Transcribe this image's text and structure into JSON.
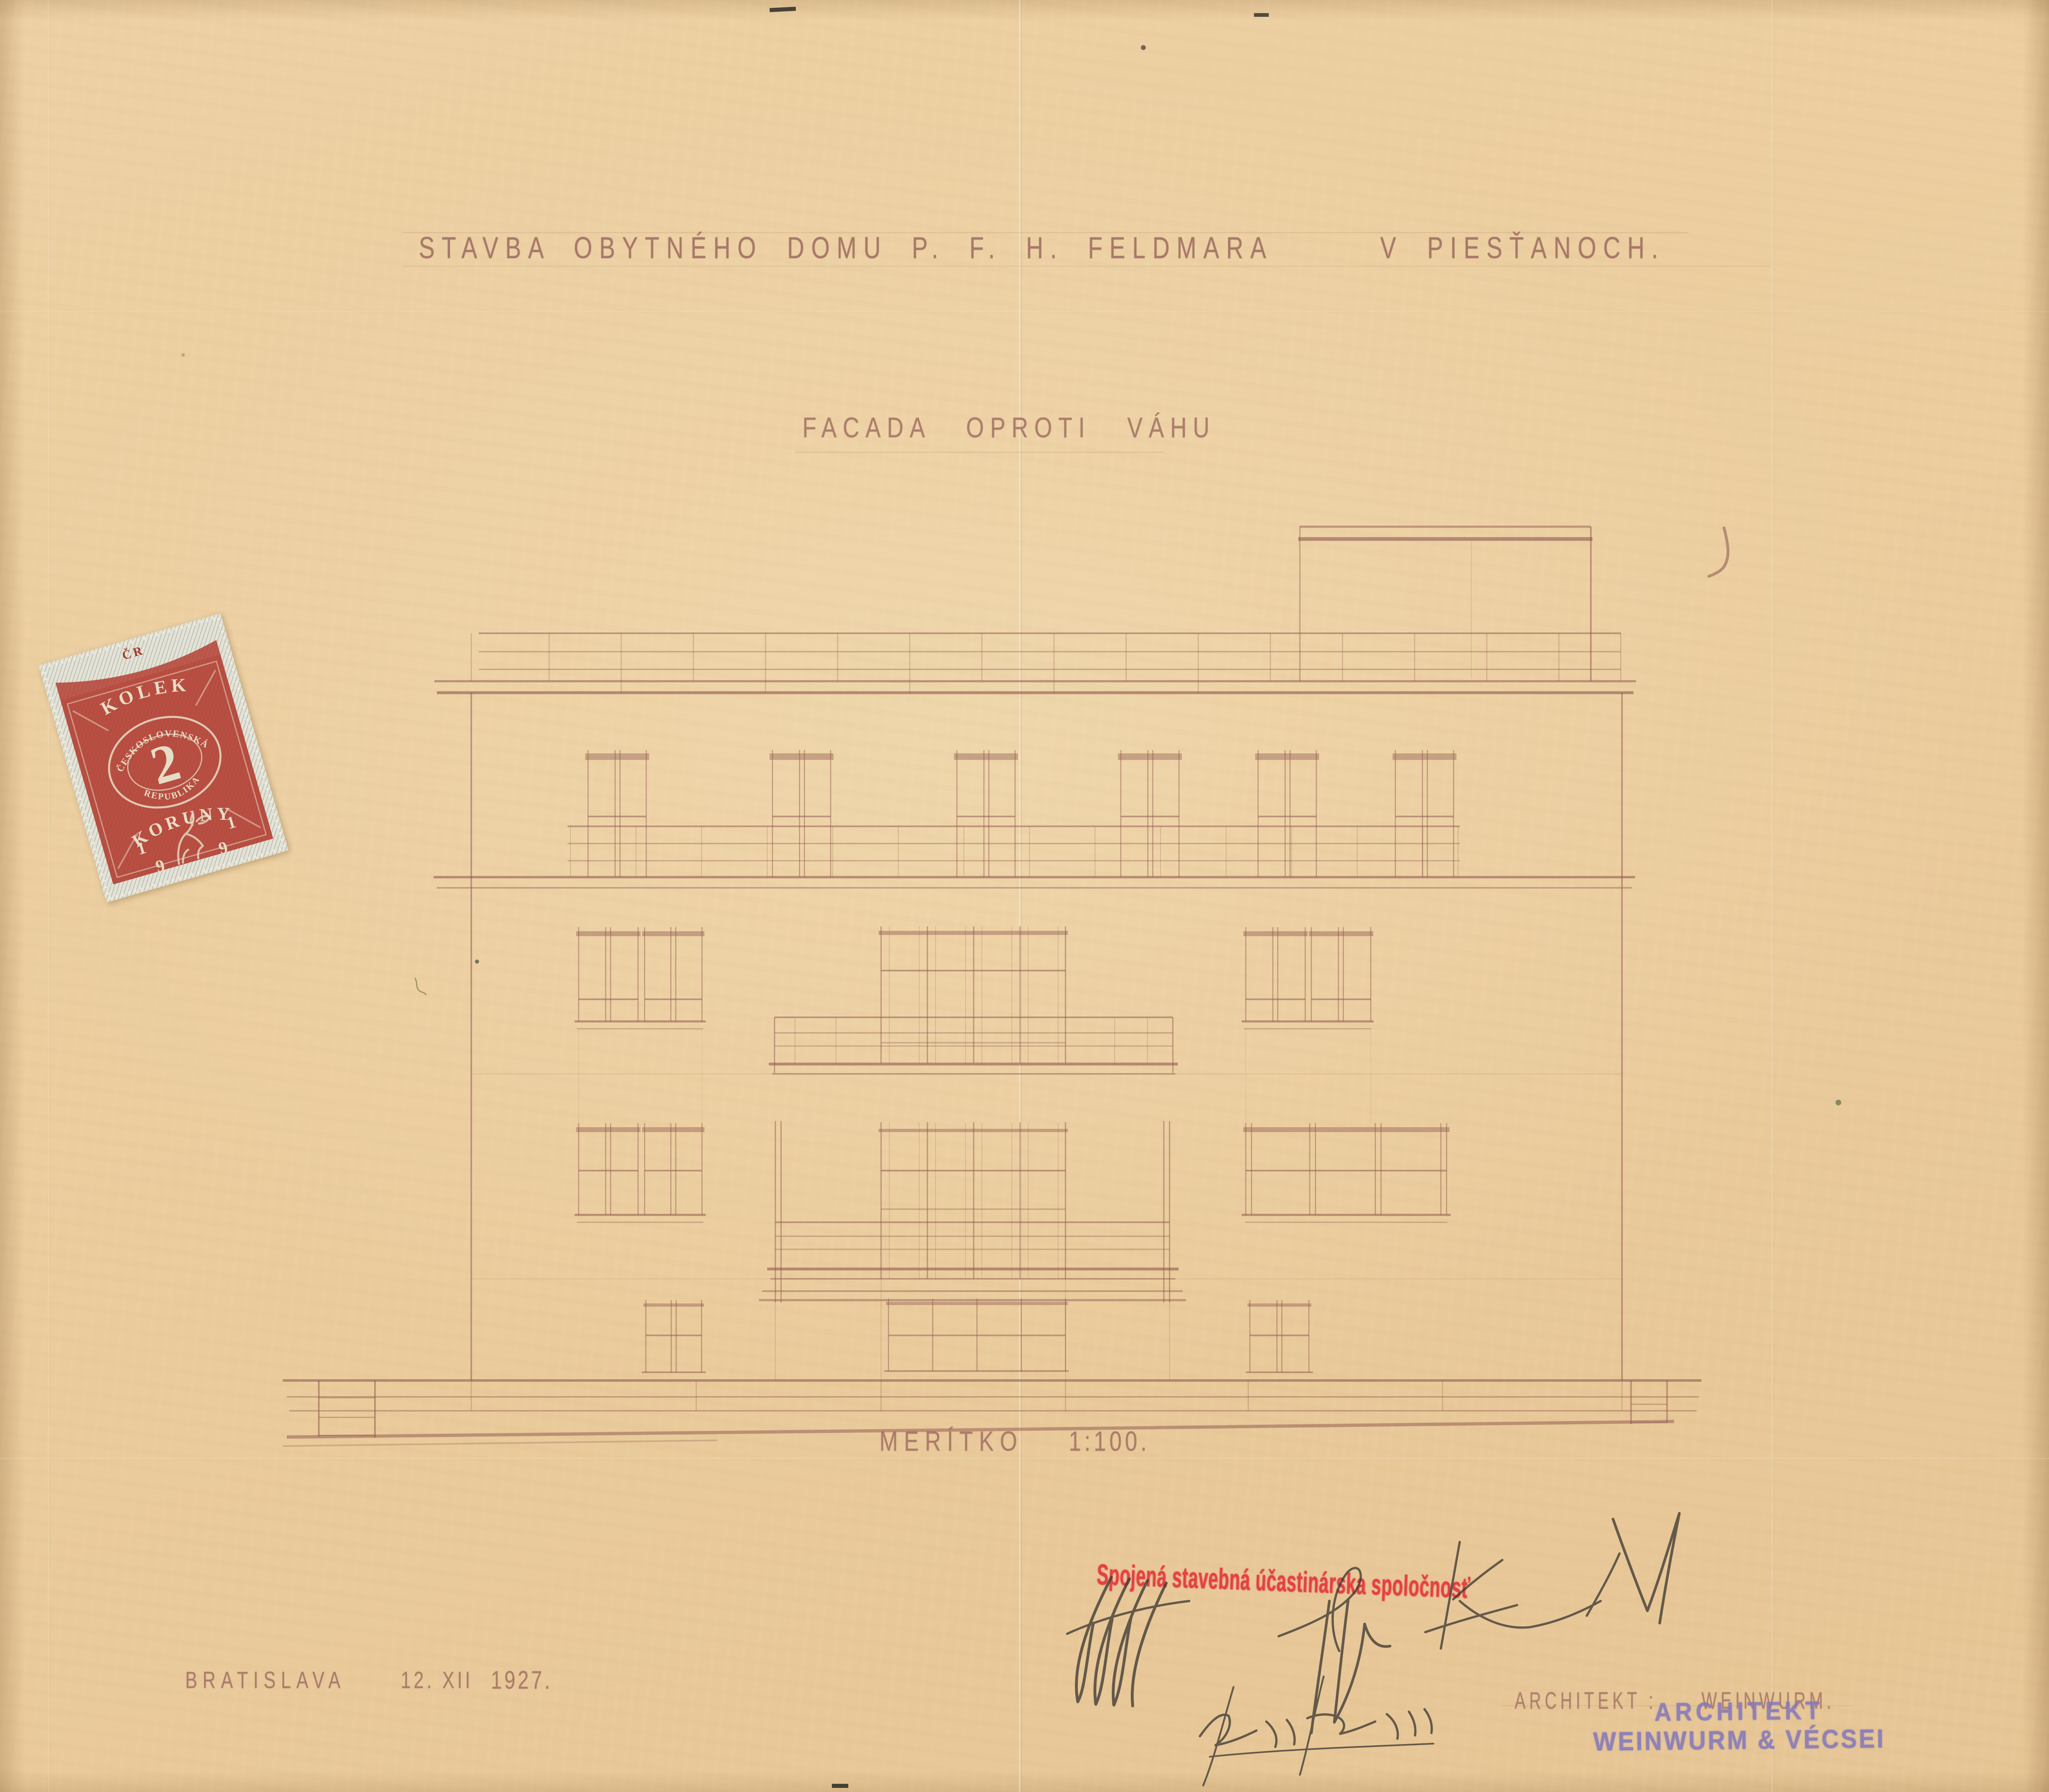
{
  "sheet": {
    "title": "STAVBA OBYTNÉHO DOMU P. F. H. FELDMARA",
    "title_location": "V PIESŤANOCH.",
    "subtitle": "FACADA OPROTI VÁHU",
    "scale_label": "MERÍTKO",
    "scale_value": "1:100.",
    "place": "BRATISLAVA",
    "date_day_month": "12. XII",
    "date_year": "1927.",
    "architect_label": "ARCHITEKT :",
    "architect_name": "WEINWURM.",
    "paper_color": "#ebcd9e",
    "ink_color": "#8d564d"
  },
  "revenue_stamp": {
    "country": "ČR",
    "kind": "KOLEK",
    "ring_top": "ČESKOSLOVENSKÁ",
    "ring_bottom": "REPUBLIKA",
    "value": "2",
    "currency": "KORUNY",
    "year_digits": [
      "1",
      "9",
      "1",
      "9"
    ],
    "ink_color": "#b23a2e"
  },
  "company_stamp": {
    "text": "Spojená stavebná účastinárska spoločnosť",
    "ink_color": "#e3373e"
  },
  "architect_stamp": {
    "line1": "ARCHITEKT",
    "line2": "WEINWURM & VÉCSEI",
    "ink_color": "#8579ba"
  }
}
